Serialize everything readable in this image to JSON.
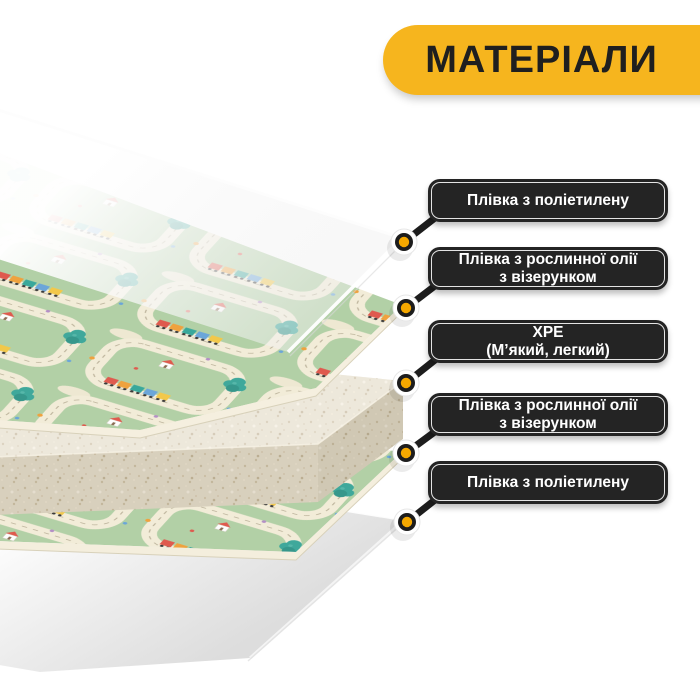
{
  "banner": {
    "label": "МАТЕРІАЛИ"
  },
  "callouts": [
    {
      "line1": "Плівка з поліетилену",
      "line2": ""
    },
    {
      "line1": "Плівка з рослинної олії",
      "line2": "з візерунком"
    },
    {
      "line1": "XPE",
      "line2": "(М’який, легкий)"
    },
    {
      "line1": "Плівка з рослинної олії",
      "line2": "з візерунком"
    },
    {
      "line1": "Плівка з поліетилену",
      "line2": ""
    }
  ],
  "layers": [
    {
      "name": "polyethylene-film-top"
    },
    {
      "name": "patterned-vegetable-oil-film-top"
    },
    {
      "name": "xpe-foam-core"
    },
    {
      "name": "patterned-vegetable-oil-film-bottom"
    },
    {
      "name": "polyethylene-film-bottom"
    }
  ],
  "colors": {
    "banner_bg": "#F6B51E",
    "banner_text": "#1F1F1F",
    "callout_bg": "#242424",
    "callout_inner_border": "#EDEDED",
    "callout_text": "#FFFFFF",
    "connector_line": "#1D1D1D",
    "connector_dot_yellow": "#F5A800",
    "connector_dot_white": "#FFFFFF",
    "mat_green": "#B2D0A6",
    "road_cream": "#F2ECD8",
    "mat_edge_cream": "#F5EFDF",
    "foam_beige": "#E6DFCD",
    "tree_teal": "#3FA89B",
    "train_red": "#DF5A4E",
    "train_orange": "#EFA23E",
    "train_blue": "#6BA6D9",
    "film_white": "#F2F2F2"
  }
}
